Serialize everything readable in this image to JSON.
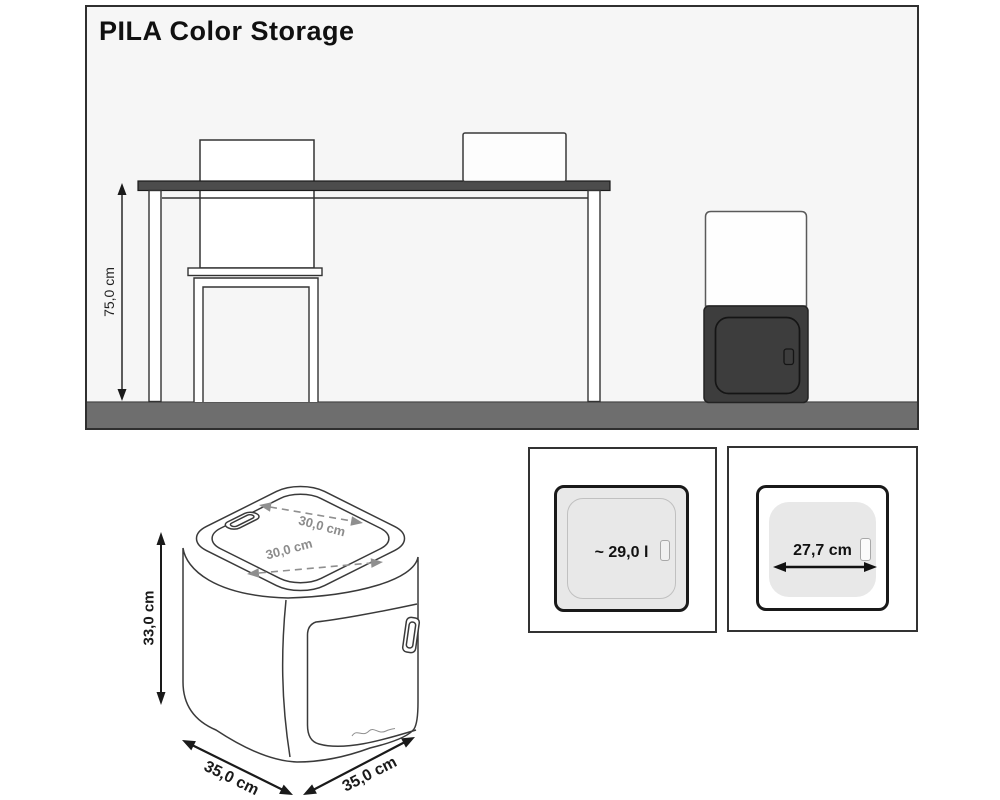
{
  "title": "PILA Color Storage",
  "scene": {
    "table_height_label": "75,0 cm"
  },
  "drawing": {
    "height_label": "33,0 cm",
    "top_depth_label": "30,0 cm",
    "top_width_label": "30,0 cm",
    "bottom_left_label": "35,0 cm",
    "bottom_right_label": "35,0 cm"
  },
  "panels": {
    "volume_label": "~ 29,0 l",
    "opening_width_label": "27,7 cm"
  },
  "colors": {
    "panel_background": "#f6f6f6",
    "floor": "#6e6e6e",
    "tabletop": "#4c4c4c",
    "product_dark": "#3d3d3d",
    "line": "#3a3a3a",
    "dimension_gray": "#8f8f8f"
  }
}
